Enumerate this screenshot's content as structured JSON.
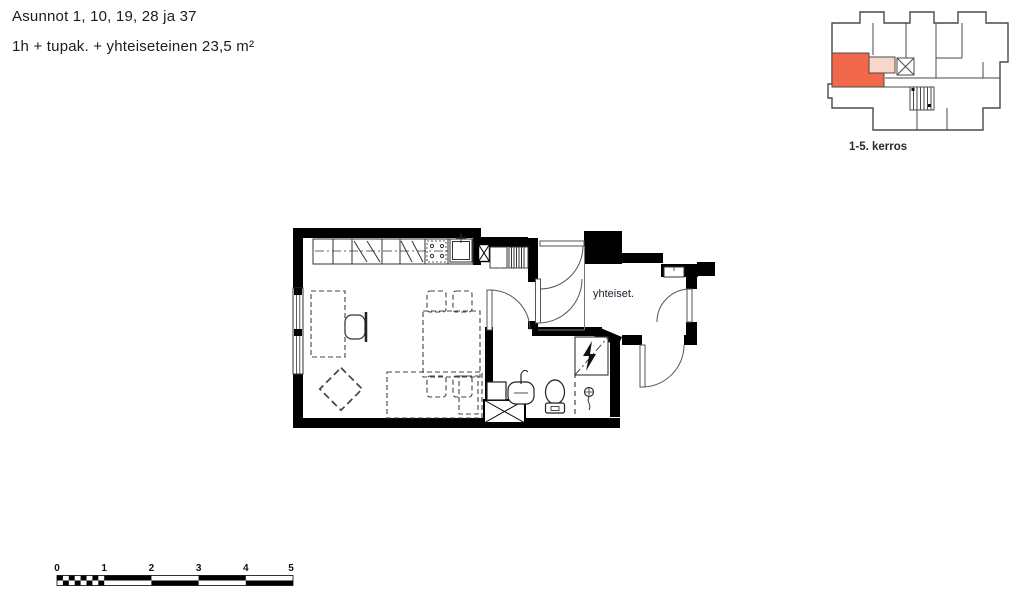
{
  "header": {
    "title": "Asunnot 1, 10, 19, 28 ja 37",
    "subtitle": "1h + tupak. + yhteiseteinen 23,5 m²"
  },
  "floor_plan": {
    "room_label": "yhteiset."
  },
  "key_plan": {
    "caption": "1-5. kerros"
  },
  "scale_bar": {
    "labels": [
      "0",
      "1",
      "2",
      "3",
      "4",
      "5"
    ]
  },
  "colors": {
    "highlight": "#f2684a",
    "highlight_light": "#f9d6c9",
    "wall": "#000000",
    "line": "#3d3d3d"
  }
}
